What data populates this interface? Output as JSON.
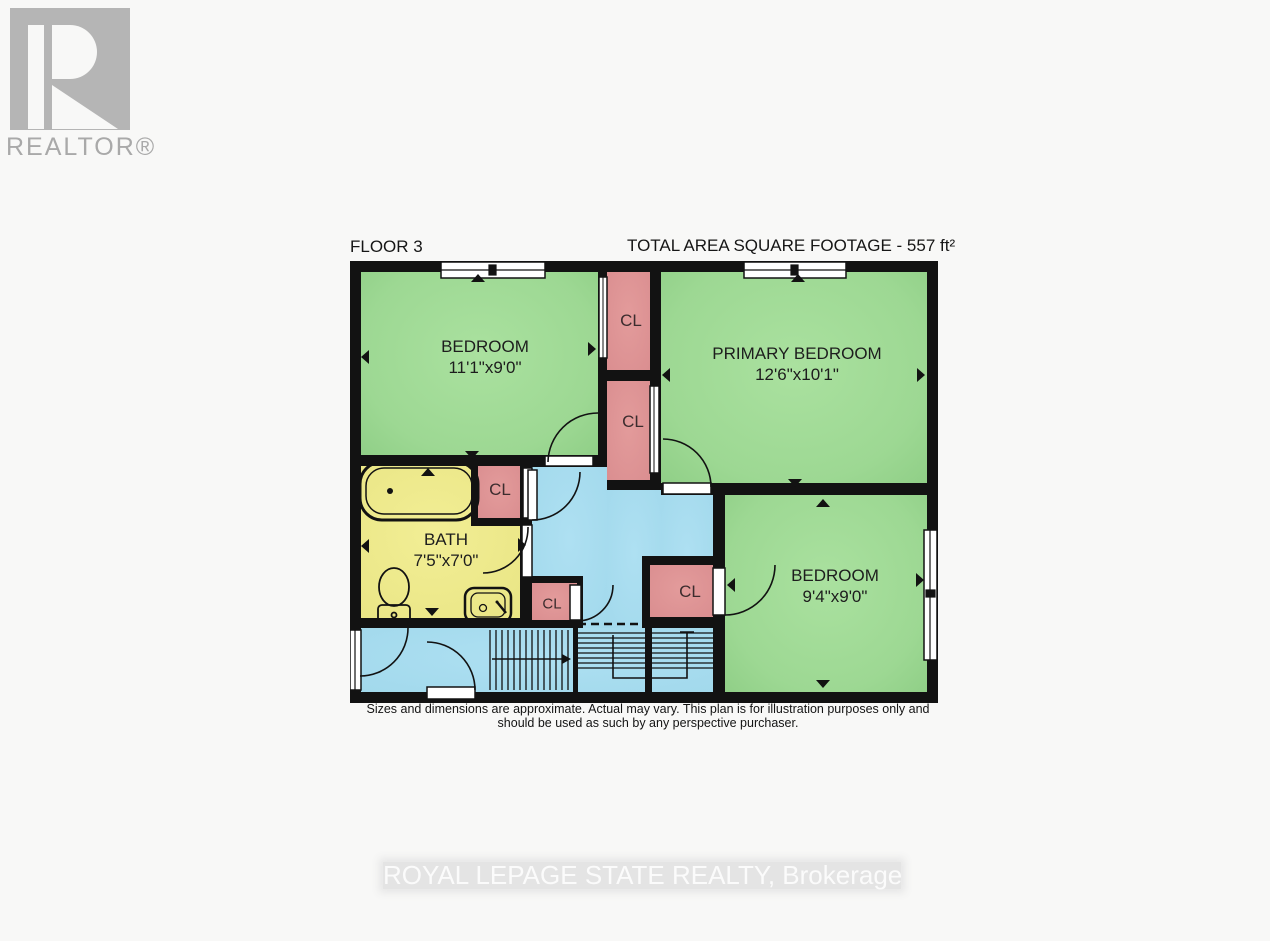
{
  "brand": {
    "logo_text": "REALTOR®",
    "watermark": "ROYAL LEPAGE STATE REALTY, Brokerage"
  },
  "header": {
    "floor_label": "FLOOR 3",
    "total_area_label": "TOTAL AREA SQUARE FOOTAGE - 557 ft²"
  },
  "rooms": {
    "bedroom_top_left": {
      "label": "BEDROOM",
      "dimensions": "11'1\"x9'0\""
    },
    "primary_bedroom": {
      "label": "PRIMARY BEDROOM",
      "dimensions": "12'6\"x10'1\""
    },
    "bedroom_bottom_right": {
      "label": "BEDROOM",
      "dimensions": "9'4\"x9'0\""
    },
    "bathroom": {
      "label": "BATH",
      "dimensions": "7'5\"x7'0\""
    },
    "closets": {
      "top_middle": "CL",
      "lower_middle": "CL",
      "bath_side": "CL",
      "hall": "CL",
      "bedroom_side": "CL"
    }
  },
  "disclaimer": {
    "line1": "Sizes and dimensions are approximate. Actual may vary. This plan is for illustration purposes only and",
    "line2": "should be used as such by any perspective purchaser."
  },
  "colors": {
    "bedroom_green": "#a0dc96",
    "closet_pink": "#df9494",
    "bath_yellow": "#efeb8d",
    "hall_blue": "#a8ddf0",
    "wall_black": "#121212",
    "logo_gray": "#b5b5b5",
    "watermark_band": "#e4e4e4",
    "watermark_text": "#fbfbfb"
  }
}
